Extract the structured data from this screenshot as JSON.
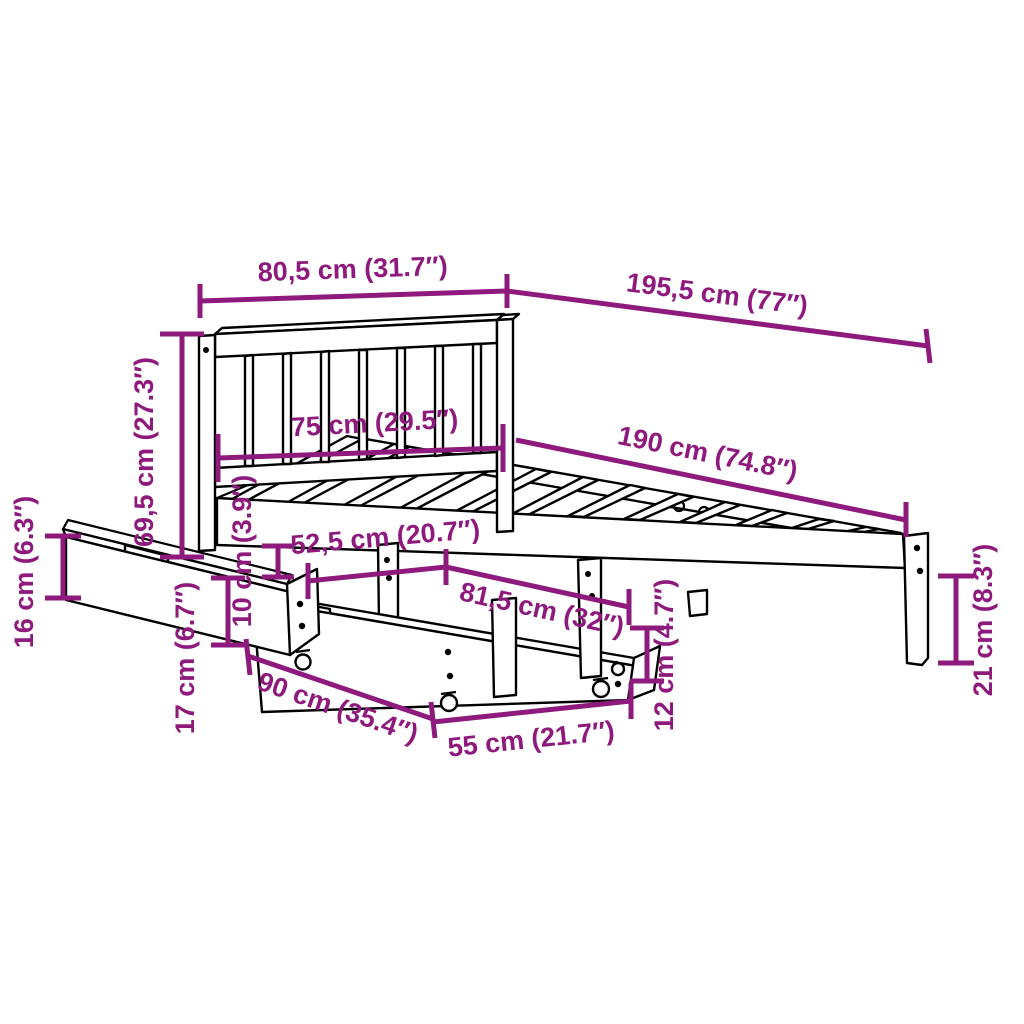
{
  "diagram": {
    "description": "Bed frame with headboard, slatted base and two under-bed storage drawers on casters — dimension drawing",
    "accent_color": "#8e1a7d",
    "outline_color": "#000000",
    "background_color": "#ffffff",
    "dimensions": {
      "headboard_width": "80,5 cm (31.7″)",
      "total_length": "195,5 cm (77″)",
      "headboard_inner_width": "75 cm (29.5″)",
      "slat_area_length": "190 cm (74.8″)",
      "headboard_height": "69,5 cm (27.3″)",
      "drawer_front_height": "16 cm (6.3″)",
      "drawer_depth": "52,5 cm (20.7″)",
      "under_bed_clearance": "10 cm (3.9″)",
      "drawer_top_length": "81,5 cm (32″)",
      "drawer_side_height": "17 cm (6.7″)",
      "drawer_width": "90 cm (35.4″)",
      "drawer_front_width": "55 cm (21.7″)",
      "caster_leg_height": "12 cm (4.7″)",
      "foot_leg_height": "21 cm (8.3″)"
    }
  }
}
